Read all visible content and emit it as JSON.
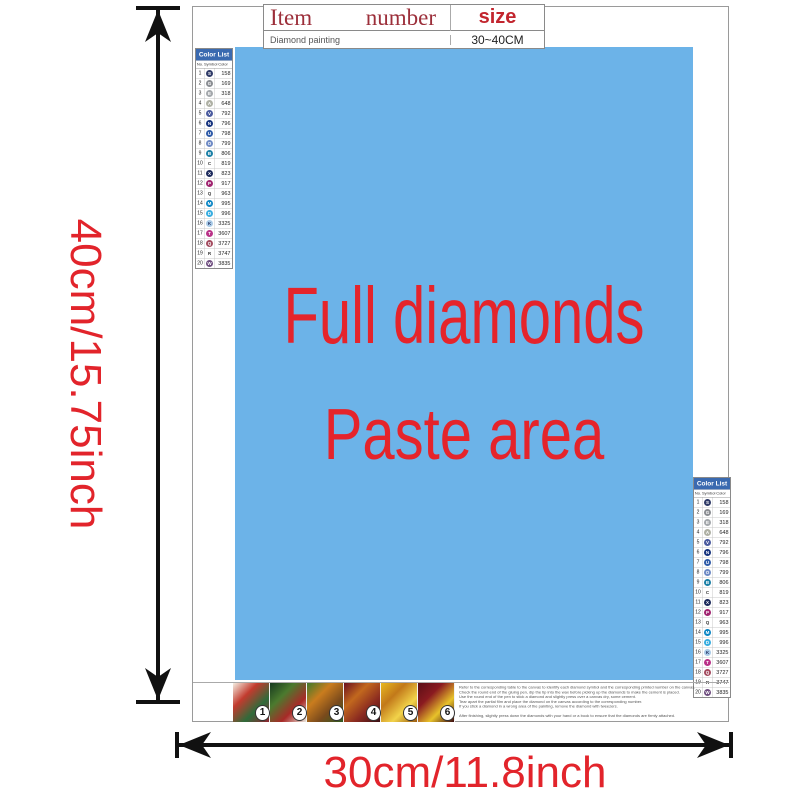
{
  "item_table": {
    "headers": {
      "item": "Item",
      "number": "number",
      "size": "size"
    },
    "row": {
      "item": "Diamond painting",
      "number": "",
      "size": "30~40CM"
    }
  },
  "paste_area": {
    "line1": "Full diamonds",
    "line2": "Paste area"
  },
  "dimension_labels": {
    "height": "40cm/15.75inch",
    "width": "30cm/11.8inch"
  },
  "colors": {
    "paste_blue": "#6cb3e8",
    "accent_red": "#e5242b",
    "table_header_red": "#9c2f3a",
    "size_header_red": "#c2252e",
    "list_header_blue": "#3a6ab0"
  },
  "color_list": {
    "title": "Color List",
    "columns": {
      "no": "No.",
      "symbol": "Symbol",
      "color": "Color"
    },
    "rows": [
      {
        "no": "1",
        "sym": "S",
        "code": "158",
        "c": "#2e3a67",
        "t": "#ffffff"
      },
      {
        "no": "2",
        "sym": "G",
        "code": "169",
        "c": "#8a8d92",
        "t": "#ffffff"
      },
      {
        "no": "3",
        "sym": "E",
        "code": "318",
        "c": "#a3a7ab",
        "t": "#ffffff"
      },
      {
        "no": "4",
        "sym": "A",
        "code": "648",
        "c": "#aeb0a4",
        "t": "#ffffff"
      },
      {
        "no": "5",
        "sym": "V",
        "code": "792",
        "c": "#4a5a9e",
        "t": "#ffffff"
      },
      {
        "no": "6",
        "sym": "N",
        "code": "796",
        "c": "#16337e",
        "t": "#ffffff"
      },
      {
        "no": "7",
        "sym": "U",
        "code": "798",
        "c": "#2f5ba8",
        "t": "#ffffff"
      },
      {
        "no": "8",
        "sym": "O",
        "code": "799",
        "c": "#6d89c4",
        "t": "#ffffff"
      },
      {
        "no": "9",
        "sym": "B",
        "code": "806",
        "c": "#1b7fa6",
        "t": "#ffffff"
      },
      {
        "no": "10",
        "sym": "C",
        "code": "819",
        "c": "",
        "t": "#333333"
      },
      {
        "no": "11",
        "sym": "X",
        "code": "823",
        "c": "#1c2a5c",
        "t": "#ffffff"
      },
      {
        "no": "12",
        "sym": "P",
        "code": "917",
        "c": "#a02470",
        "t": "#ffffff"
      },
      {
        "no": "13",
        "sym": "Q",
        "code": "963",
        "c": "",
        "t": "#333333"
      },
      {
        "no": "14",
        "sym": "M",
        "code": "995",
        "c": "#0a85c4",
        "t": "#ffffff"
      },
      {
        "no": "15",
        "sym": "D",
        "code": "996",
        "c": "#38ade0",
        "t": "#ffffff"
      },
      {
        "no": "16",
        "sym": "K",
        "code": "3325",
        "c": "#a9cbe8",
        "t": "#1c2a5c"
      },
      {
        "no": "17",
        "sym": "T",
        "code": "3607",
        "c": "#b93288",
        "t": "#ffffff"
      },
      {
        "no": "18",
        "sym": "Q",
        "code": "3727",
        "c": "#a34a5e",
        "t": "#ffffff"
      },
      {
        "no": "19",
        "sym": "R",
        "code": "3747",
        "c": "",
        "t": "#333333"
      },
      {
        "no": "20",
        "sym": "W",
        "code": "3835",
        "c": "#6f4e80",
        "t": "#ffffff"
      }
    ]
  },
  "thumbnails": {
    "items": [
      {
        "n": "1",
        "g": [
          "#f4eee2",
          "#c23b2e",
          "#2f6b3a",
          "#8f2430"
        ]
      },
      {
        "n": "2",
        "g": [
          "#173a1f",
          "#4b7a2e",
          "#a82a28",
          "#e8e4da"
        ]
      },
      {
        "n": "3",
        "g": [
          "#3f7a2c",
          "#c97c1e",
          "#7a4a1c",
          "#2f5b22"
        ]
      },
      {
        "n": "4",
        "g": [
          "#6b1020",
          "#c2681e",
          "#8a2a20",
          "#3a0f14"
        ]
      },
      {
        "n": "5",
        "g": [
          "#e8b820",
          "#c2791a",
          "#f2d34a",
          "#9a5a10"
        ]
      },
      {
        "n": "6",
        "g": [
          "#5a0f16",
          "#8a1a20",
          "#e8c22a",
          "#3a0a10"
        ]
      }
    ]
  },
  "instructions": {
    "lines": [
      {
        "t": "Refer to the corresponding table to the canvas to identify each diamond symbol and the corresponding printed number on the canvas."
      },
      {
        "t": "Check the round end of the gluing pen, dip the tip into the wax before picking up the diamonds to make the cement is placed."
      },
      {
        "t": "Use the round end of the pen to stick a diamond and slightly press over a canvas dry, some cement."
      },
      {
        "t": "Tear apart the partial film and place the diamond on the canvas according to the corresponding number."
      },
      {
        "t": "If you stick a diamond in a wrong area of the painting, remove the diamond with tweezers."
      },
      {
        "t": "After finishing, slightly press down the diamonds with your hand or a book to ensure that the diamonds are firmly attached."
      }
    ]
  }
}
